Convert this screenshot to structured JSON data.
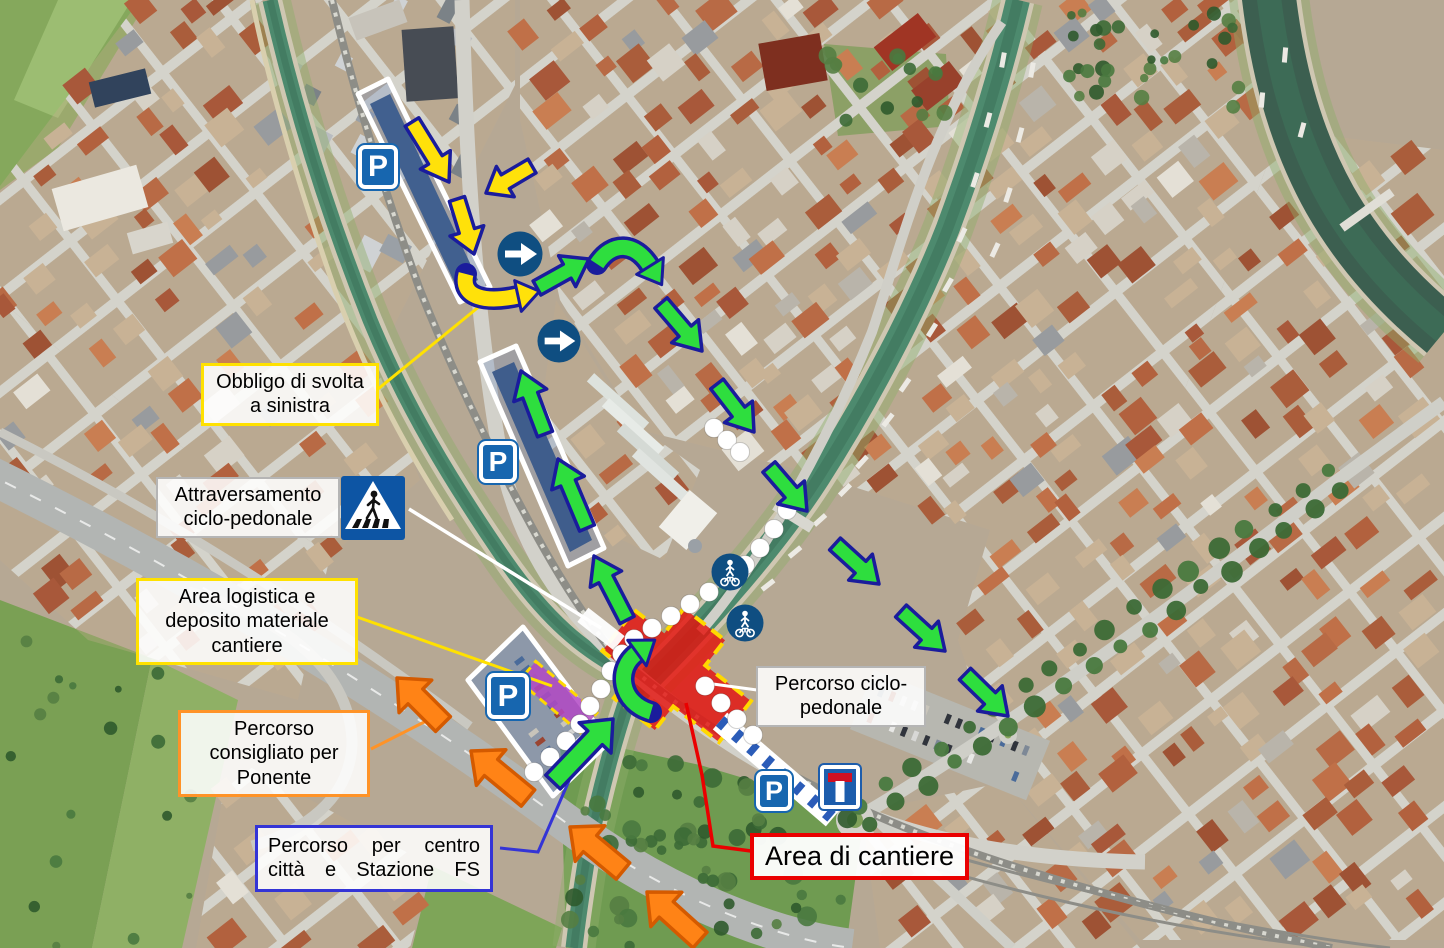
{
  "labels": {
    "obbligo_svolta": "Obbligo di svolta a sinistra",
    "attraversamento": "Attraversamento ciclo-pedonale",
    "area_logistica": "Area logistica e deposito materiale cantiere",
    "percorso_ponente": "Percorso consigliato per Ponente",
    "percorso_centro": "Percorso per centro città e Stazione FS",
    "percorso_ciclopedonale": "Percorso ciclo-pedonale",
    "area_cantiere": "Area di cantiere"
  },
  "signs": {
    "parking_letter": "P",
    "icons": [
      "parking-sign",
      "dead-end-sign",
      "mandatory-right-turn-sign",
      "pedestrian-crossing-sign",
      "shared-pedestrian-bicycle-path-sign"
    ]
  },
  "colors": {
    "route_green": "#2ede3e",
    "route_yellow": "#ffe10a",
    "route_orange": "#ff8316",
    "route_outline": "#1a1c9c",
    "orange_outline": "#d45a00",
    "construction_red": "#e41512",
    "zone_dash_yellow": "#ffd800",
    "logistics_purple": "#b44fc6",
    "sign_blue": "#1766af",
    "water": "#4d8a6e"
  }
}
